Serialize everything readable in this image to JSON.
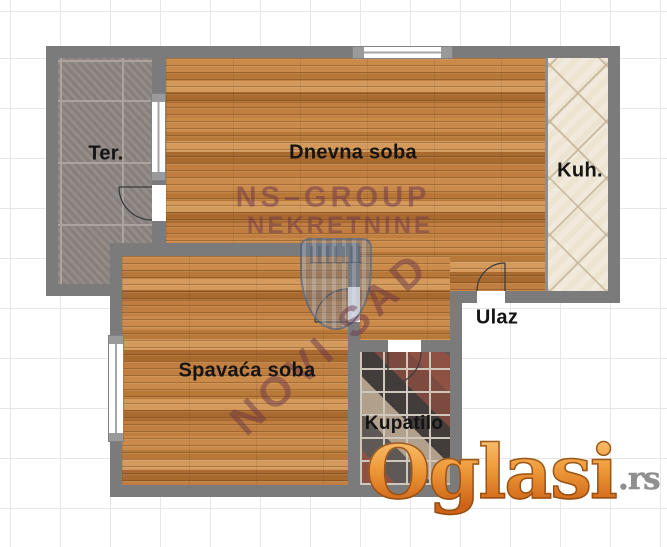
{
  "rooms": [
    {
      "name": "terrace",
      "label": "Ter."
    },
    {
      "name": "living-room",
      "label": "Dnevna soba"
    },
    {
      "name": "kitchen",
      "label": "Kuh."
    },
    {
      "name": "entrance",
      "label": "Ulaz"
    },
    {
      "name": "bedroom",
      "label": "Spavaća soba"
    },
    {
      "name": "bathroom",
      "label": "Kupatilo"
    }
  ],
  "watermark": {
    "agency_line1": "NS–GROUP",
    "agency_line2": "NEKRETNINE",
    "city": "NOVI SAD"
  },
  "logo": {
    "brand": "Oglasi",
    "tld": ".rs"
  },
  "colors": {
    "wall": "#7b7b7b",
    "wood": "#c08040",
    "terrace_tile": "#8d8683",
    "kitchen_tile": "#ece3d1",
    "watermark_plum": "#70384e",
    "shield_blue": "#607694",
    "logo_orange": "#ef9a3a",
    "logo_tld_gray": "#8f8f8f"
  }
}
